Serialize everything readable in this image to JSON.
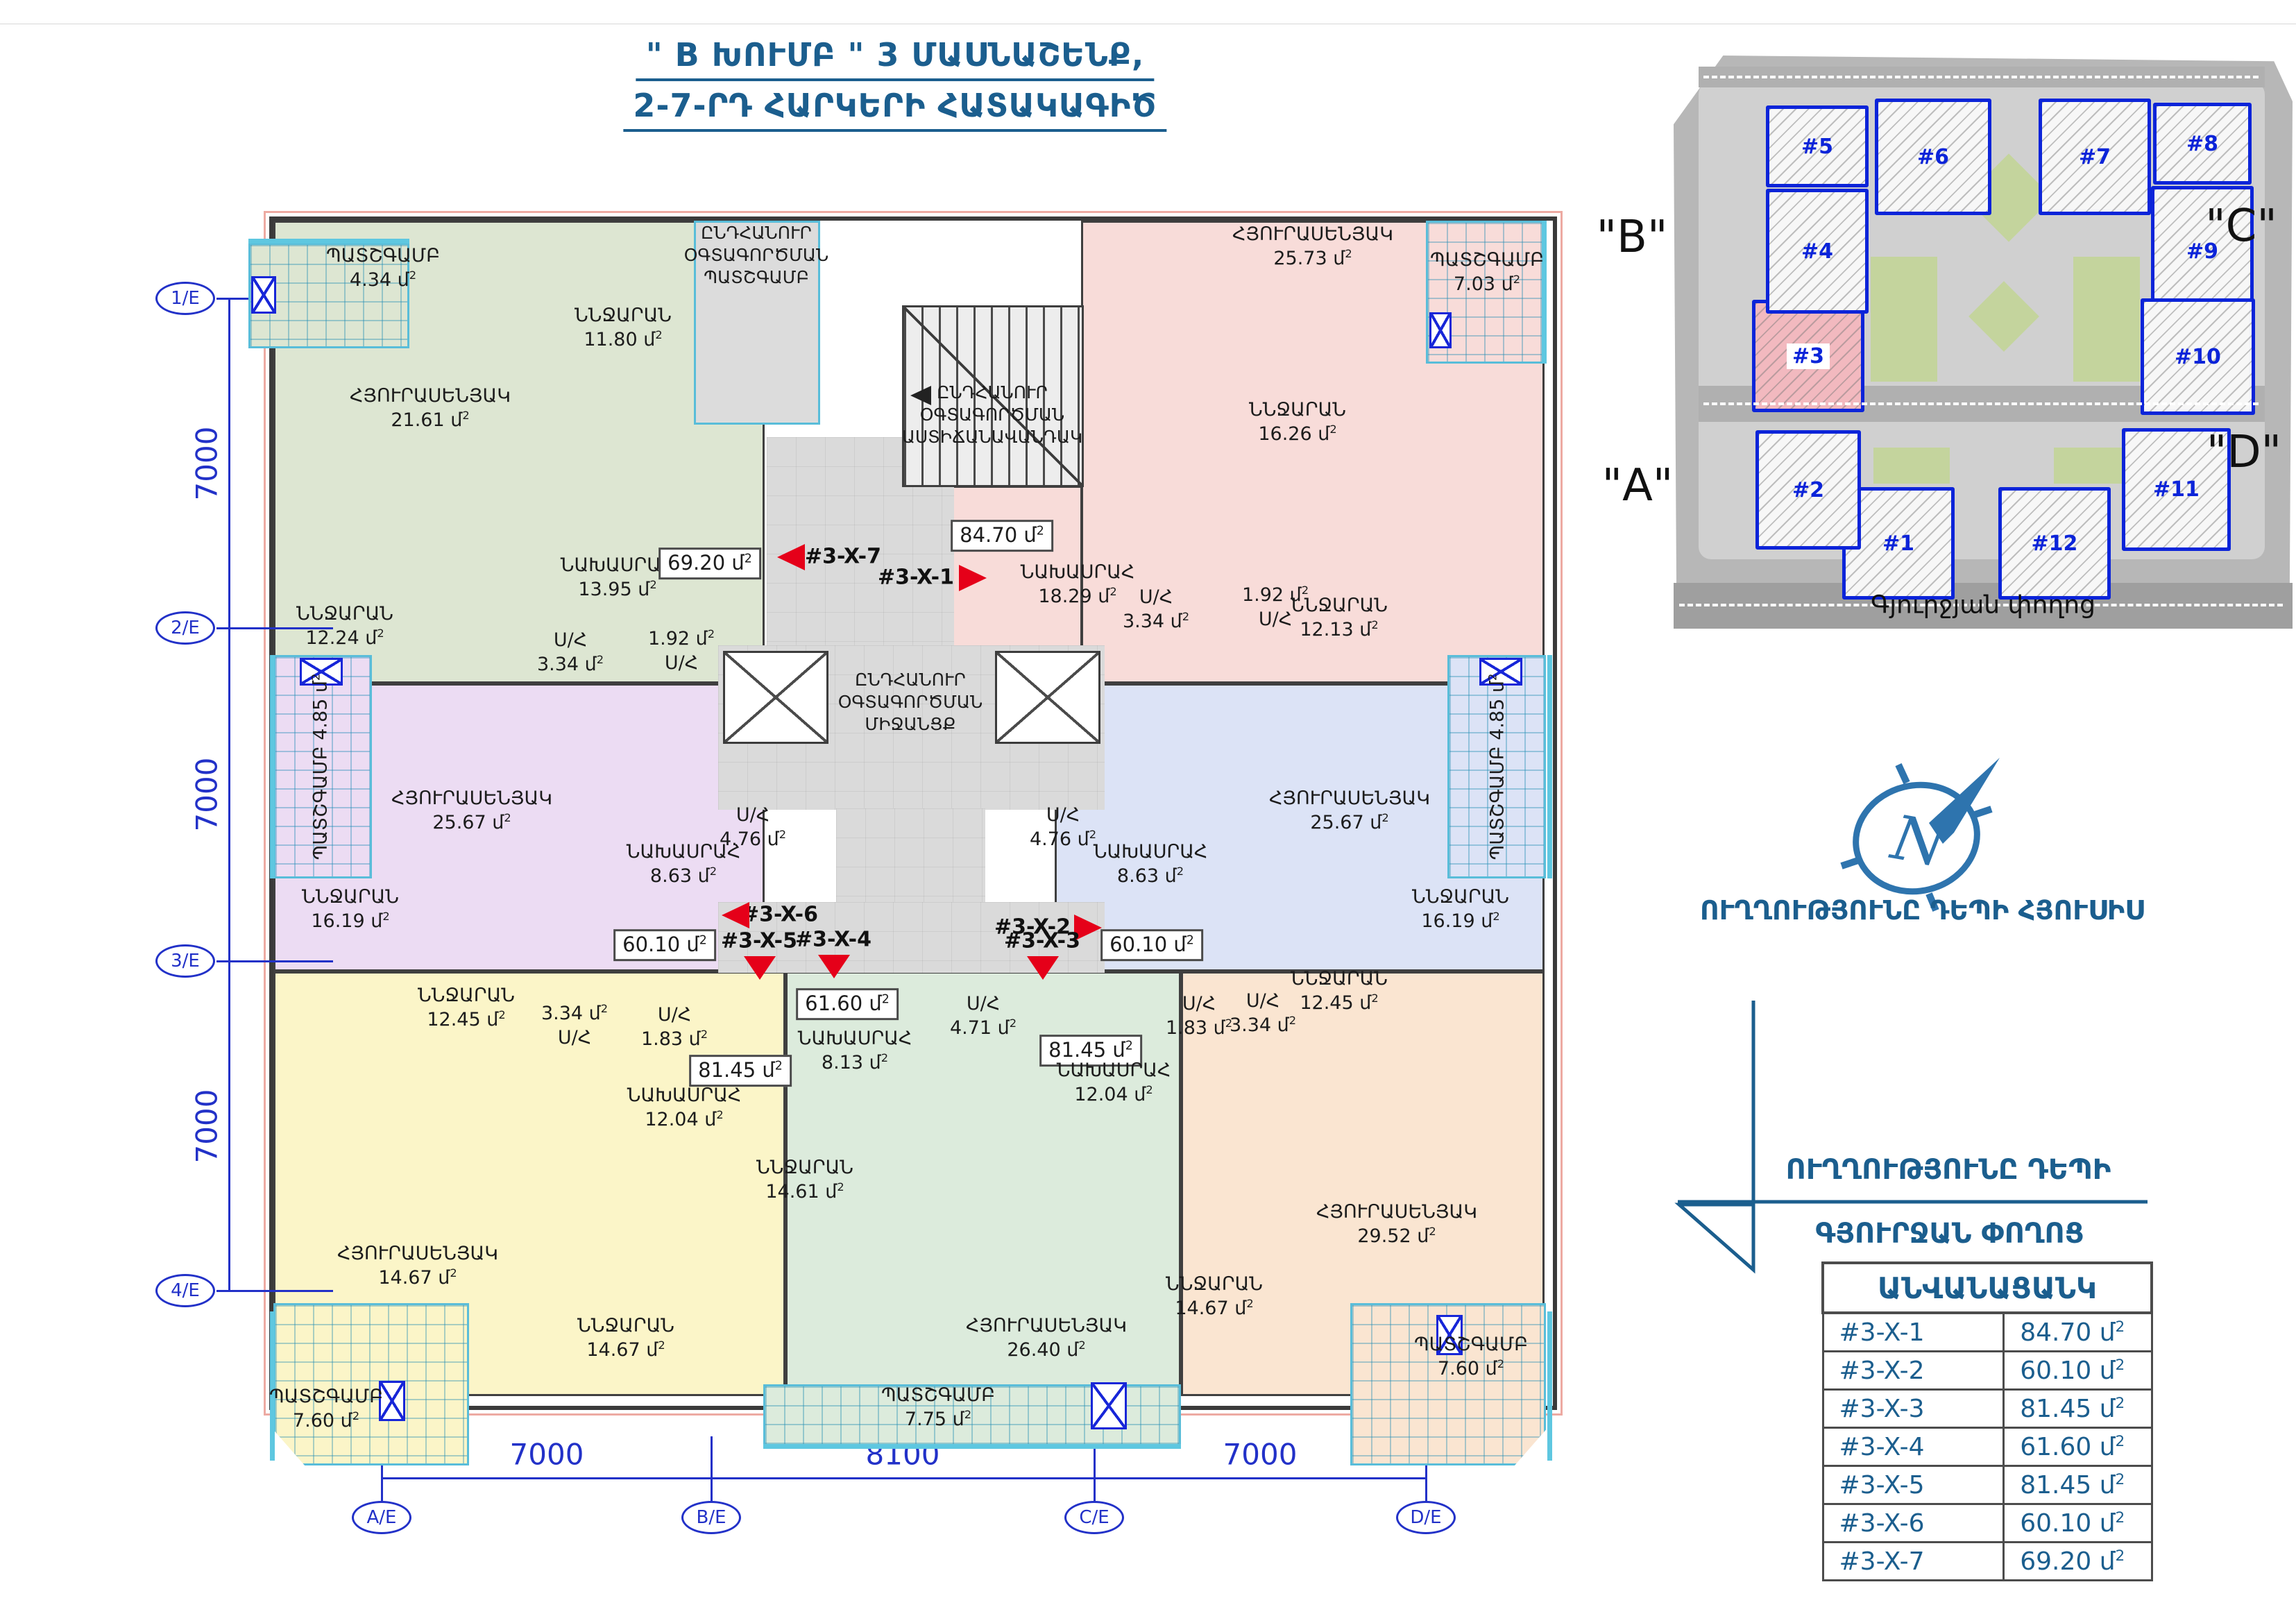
{
  "title": {
    "line1": "\" B ԽՈՒՄԲ \" 3 ՄԱՍՆԱՇԵՆՔ,",
    "line2": "2-7-ՐԴ  ՀԱՐԿԵՐԻ ՀԱՏԱԿԱԳԻԾ"
  },
  "colors": {
    "accent": "#1b5e8e",
    "axis_blue": "#2231c8",
    "arrow_red": "#e50019",
    "site_outline": "#0b24d9",
    "site_highlight": "#f2b9bf",
    "wall": "#3f3f3f"
  },
  "unit": "մ",
  "unit_sup": "2",
  "axes": {
    "left": [
      "1/E",
      "2/E",
      "3/E",
      "4/E"
    ],
    "left_dims": [
      "7000",
      "7000",
      "7000"
    ],
    "bottom": [
      "A/E",
      "B/E",
      "C/E",
      "D/E"
    ],
    "bottom_dims": [
      "7000",
      "8100",
      "7000"
    ]
  },
  "plan": {
    "apartments": [
      {
        "code": "#3-X-7",
        "area": "69.20",
        "color": "#dde6d2",
        "rooms": [
          {
            "id": "g-balc",
            "name": "ՊԱՏՇԳԱՄԲ",
            "value": "4.34"
          },
          {
            "id": "g-living",
            "name": "ՀՅՈՒՐԱՍԵՆՅԱԿ",
            "value": "21.61"
          },
          {
            "id": "g-bed1",
            "name": "ՆՆՋԱՐԱՆ",
            "value": "11.80"
          },
          {
            "id": "g-bed2",
            "name": "ՆՆՋԱՐԱՆ",
            "value": "12.24"
          },
          {
            "id": "g-hall",
            "name": "ՆԱԽԱՍՐԱՀ",
            "value": "13.95"
          },
          {
            "id": "g-sh1",
            "name": "Ս/Հ",
            "value": "3.34"
          },
          {
            "id": "g-sh2",
            "name": "Ս/Հ",
            "value": "1.92"
          },
          {
            "id": "g-area",
            "name": "",
            "value": "69.20"
          }
        ]
      },
      {
        "code": "#3-X-1",
        "area": "84.70",
        "color": "#f8dcd9",
        "rooms": [
          {
            "id": "p-area",
            "name": "",
            "value": "84.70"
          },
          {
            "id": "p-hall",
            "name": "ՆԱԽԱՍՐԱՀ",
            "value": "18.29"
          },
          {
            "id": "p-living",
            "name": "ՀՅՈՒՐԱՍԵՆՅԱԿ",
            "value": "25.73"
          },
          {
            "id": "p-balc",
            "name": "ՊԱՏՇԳԱՄԲ",
            "value": "7.03"
          },
          {
            "id": "p-bed1",
            "name": "ՆՆՋԱՐԱՆ",
            "value": "16.26"
          },
          {
            "id": "p-bed2",
            "name": "ՆՆՋԱՐԱՆ",
            "value": "12.13"
          },
          {
            "id": "p-sh1",
            "name": "Ս/Հ",
            "value": "3.34"
          },
          {
            "id": "p-sh2",
            "name": "Ս/Հ",
            "value": "1.92"
          }
        ]
      },
      {
        "code": "#3-X-6",
        "area": "60.10",
        "color": "#ecdcf3",
        "rooms": [
          {
            "id": "l-balc",
            "name": "ՊԱՏՇԳԱՄԲ",
            "value": "4.85"
          },
          {
            "id": "l-living",
            "name": "ՀՅՈՒՐԱՍԵՆՅԱԿ",
            "value": "25.67"
          },
          {
            "id": "l-bed",
            "name": "ՆՆՋԱՐԱՆ",
            "value": "16.19"
          },
          {
            "id": "l-hall",
            "name": "ՆԱԽԱՍՐԱՀ",
            "value": "8.63"
          },
          {
            "id": "l-sh",
            "name": "Ս/Հ",
            "value": "4.76"
          },
          {
            "id": "l-area",
            "name": "",
            "value": "60.10"
          }
        ]
      },
      {
        "code": "#3-X-2",
        "area": "60.10",
        "color": "#dce3f6",
        "rooms": [
          {
            "id": "b-balc",
            "name": "ՊԱՏՇԳԱՄԲ",
            "value": "4.85"
          },
          {
            "id": "b-living",
            "name": "ՀՅՈՒՐԱՍԵՆՅԱԿ",
            "value": "25.67"
          },
          {
            "id": "b-bed",
            "name": "ՆՆՋԱՐԱՆ",
            "value": "16.19"
          },
          {
            "id": "b-hall",
            "name": "ՆԱԽԱՍՐԱՀ",
            "value": "8.63"
          },
          {
            "id": "b-sh",
            "name": "Ս/Հ",
            "value": "4.76"
          },
          {
            "id": "b-area",
            "name": "",
            "value": "60.10"
          }
        ]
      },
      {
        "code": "#3-X-5",
        "area": "81.45",
        "color": "#fbf5c8",
        "rooms": [
          {
            "id": "y-bed1",
            "name": "ՆՆՋԱՐԱՆ",
            "value": "12.45"
          },
          {
            "id": "y-sh1",
            "name": "Ս/Հ",
            "value": "3.34"
          },
          {
            "id": "y-sh2",
            "name": "Ս/Հ",
            "value": "1.83"
          },
          {
            "id": "y-area",
            "name": "",
            "value": "81.45"
          },
          {
            "id": "y-hall",
            "name": "ՆԱԽԱՍՐԱՀ",
            "value": "12.04"
          },
          {
            "id": "y-living",
            "name": "ՀՅՈՒՐԱՍԵՆՅԱԿ",
            "value": "14.67"
          },
          {
            "id": "y-bed2",
            "name": "ՆՆՋԱՐԱՆ",
            "value": "14.67"
          },
          {
            "id": "y-balc",
            "name": "ՊԱՏՇԳԱՄԲ",
            "value": "7.60"
          }
        ]
      },
      {
        "code": "#3-X-4",
        "area": "61.60",
        "color": "#dcebdc",
        "rooms": [
          {
            "id": "m-area",
            "name": "",
            "value": "61.60"
          },
          {
            "id": "m-hall",
            "name": "ՆԱԽԱՍՐԱՀ",
            "value": "8.13"
          },
          {
            "id": "m-sh",
            "name": "Ս/Հ",
            "value": "4.71"
          },
          {
            "id": "m-bed",
            "name": "ՆՆՋԱՐԱՆ",
            "value": "14.61"
          },
          {
            "id": "m-living",
            "name": "ՀՅՈՒՐԱՍԵՆՅԱԿ",
            "value": "26.40"
          },
          {
            "id": "m-balc",
            "name": "ՊԱՏՇԳԱՄԲ",
            "value": "7.75"
          }
        ]
      },
      {
        "code": "#3-X-3",
        "area": "81.45",
        "color": "#fae5d1",
        "rooms": [
          {
            "id": "pe-bed1",
            "name": "ՆՆՋԱՐԱՆ",
            "value": "12.45"
          },
          {
            "id": "pe-sh1",
            "name": "Ս/Հ",
            "value": "1.83"
          },
          {
            "id": "pe-sh2",
            "name": "Ս/Հ",
            "value": "3.34"
          },
          {
            "id": "pe-area",
            "name": "",
            "value": "81.45"
          },
          {
            "id": "pe-hall",
            "name": "ՆԱԽԱՍՐԱՀ",
            "value": "12.04"
          },
          {
            "id": "pe-bed2",
            "name": "ՆՆՋԱՐԱՆ",
            "value": "14.67"
          },
          {
            "id": "pe-living",
            "name": "ՀՅՈՒՐԱՍԵՆՅԱԿ",
            "value": "29.52"
          },
          {
            "id": "pe-balc",
            "name": "ՊԱՏՇԳԱՄԲ",
            "value": "7.60"
          }
        ]
      }
    ],
    "commons": {
      "stairwell": [
        "ԸՆԴՀԱՆՈՒՐ",
        "ՕԳՏԱԳՈՐԾՄԱՆ",
        "ԱՍՏԻՃԱՆԱՎԱՆԴԱԿ"
      ],
      "corridor": [
        "ԸՆԴՀԱՆՈՒՐ",
        "ՕԳՏԱԳՈՐԾՄԱՆ",
        "ՄԻՋԱՆՑՔ"
      ],
      "balcony": [
        "ԸՆԴՀԱՆՈՒՐ",
        "ՕԳՏԱԳՈՐԾՄԱՆ",
        "ՊԱՏՇԳԱՄԲ"
      ]
    },
    "entries": [
      "#3-X-7",
      "#3-X-1",
      "#3-X-6",
      "#3-X-2",
      "#3-X-5",
      "#3-X-4",
      "#3-X-3"
    ]
  },
  "site_plan": {
    "quadrants": [
      "\"B\"",
      "\"C\"",
      "\"A\"",
      "\"D\""
    ],
    "street": "Գյուրջյան փողոց",
    "highlighted": "#3",
    "buildings": [
      "#1",
      "#2",
      "#3",
      "#4",
      "#5",
      "#6",
      "#7",
      "#8",
      "#9",
      "#10",
      "#11",
      "#12"
    ]
  },
  "compass": {
    "label": "ՈՒՂՂՈՒԹՅՈՒՆԸ ԴԵՊԻ ՀՅՈՒՍԻՍ"
  },
  "street_direction": {
    "line1": "ՈՒՂՂՈՒԹՅՈՒՆԸ ԴԵՊԻ",
    "line2": "ԳՅՈՒՐՋԱՆ ՓՈՂՈՑ"
  },
  "legend_table": {
    "title": "ԱՆՎԱՆԱՑԱՆԿ",
    "rows": [
      {
        "code": "#3-X-1",
        "area": "84.70"
      },
      {
        "code": "#3-X-2",
        "area": "60.10"
      },
      {
        "code": "#3-X-3",
        "area": "81.45"
      },
      {
        "code": "#3-X-4",
        "area": "61.60"
      },
      {
        "code": "#3-X-5",
        "area": "81.45"
      },
      {
        "code": "#3-X-6",
        "area": "60.10"
      },
      {
        "code": "#3-X-7",
        "area": "69.20"
      }
    ]
  }
}
